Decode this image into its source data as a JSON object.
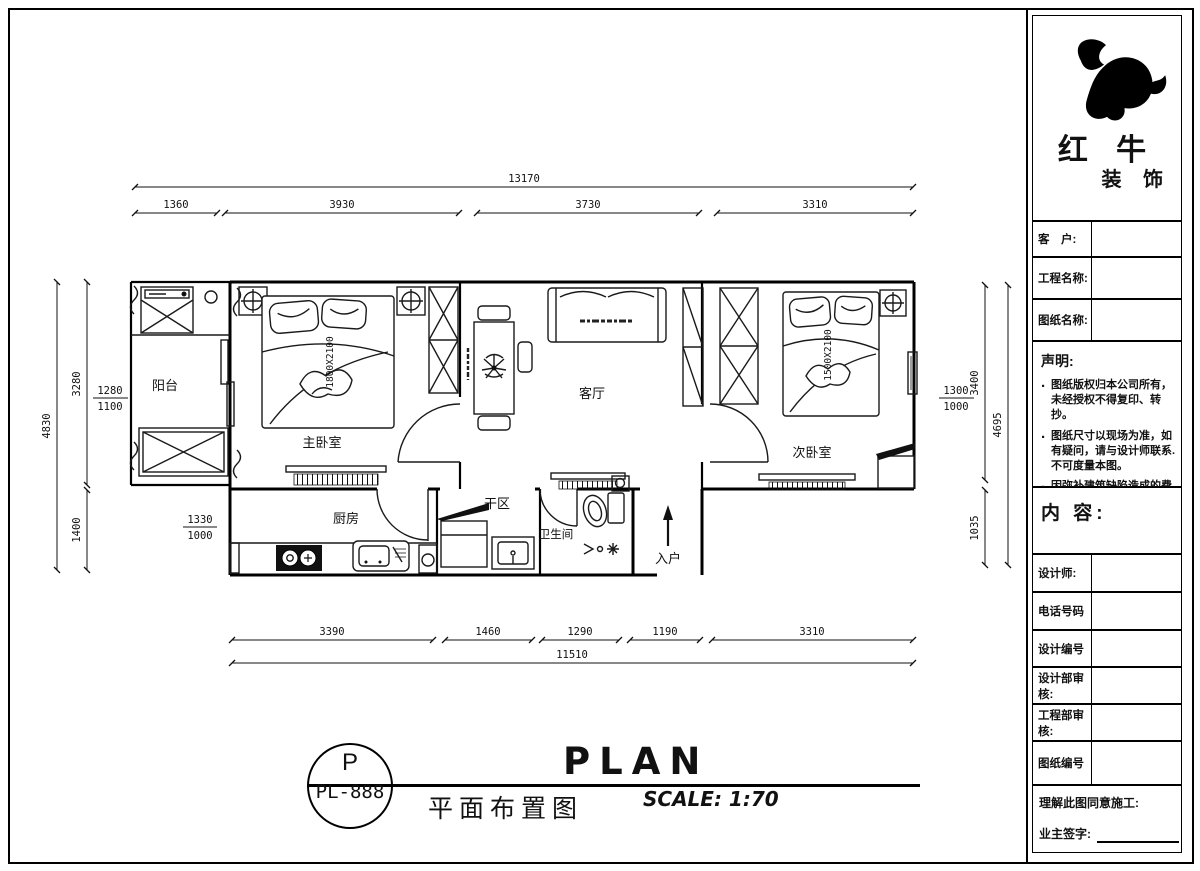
{
  "sidebar": {
    "brand": {
      "line1": "红 牛",
      "line2": "装 饰"
    },
    "customer_label": "客　户:",
    "project_label": "工程名称:",
    "drawing_label": "图纸名称:",
    "statement_title": "声明:",
    "statement_items": [
      "图纸版权归本公司所有，未经授权不得复印、转抄。",
      "图纸尺寸以现场为准，如有疑问，请与设计师联系.不可度量本图。",
      "因弥补建筑缺陷造成的费用增加与设计无关。"
    ],
    "content_label": "内 容:",
    "rows": [
      "设计师:",
      "电话号码",
      "设计编号",
      "设计部审核:",
      "工程部审核:",
      "图纸编号"
    ],
    "agreement_label": "理解此图同意施工:",
    "signature_label": "业主签字:"
  },
  "plan": {
    "rooms": {
      "balcony": "阳台",
      "master_bedroom": "主卧室",
      "living_room": "客厅",
      "second_bedroom": "次卧室",
      "kitchen": "厨房",
      "dry_area": "干区",
      "bathroom": "卫生间"
    },
    "entrance_label": "入户",
    "master_bed_size": "1800X2100",
    "second_bed_size": "1500X2100"
  },
  "dimensions": {
    "top_total": "13170",
    "top_segments": [
      "1360",
      "3930",
      "3730",
      "3310"
    ],
    "bottom_segments": [
      "3390",
      "1460",
      "1290",
      "1190",
      "3310"
    ],
    "bottom_total": "11510",
    "left_total": "4830",
    "left_upper": "3280",
    "left_lower": "1400",
    "balcony_fraction_top": "1280",
    "balcony_fraction_bottom": "1100",
    "kitchen_fraction_top": "1330",
    "kitchen_fraction_bottom": "1000",
    "right_fraction_top": "1300",
    "right_fraction_bottom": "1000",
    "right_upper": "3400",
    "right_total": "4695",
    "right_lower": "1035"
  },
  "footer": {
    "stamp_letter": "P",
    "stamp_code": "PL-888",
    "title_cn": "平面布置图",
    "title_en": "PLAN",
    "scale_text": "SCALE: 1:70"
  }
}
